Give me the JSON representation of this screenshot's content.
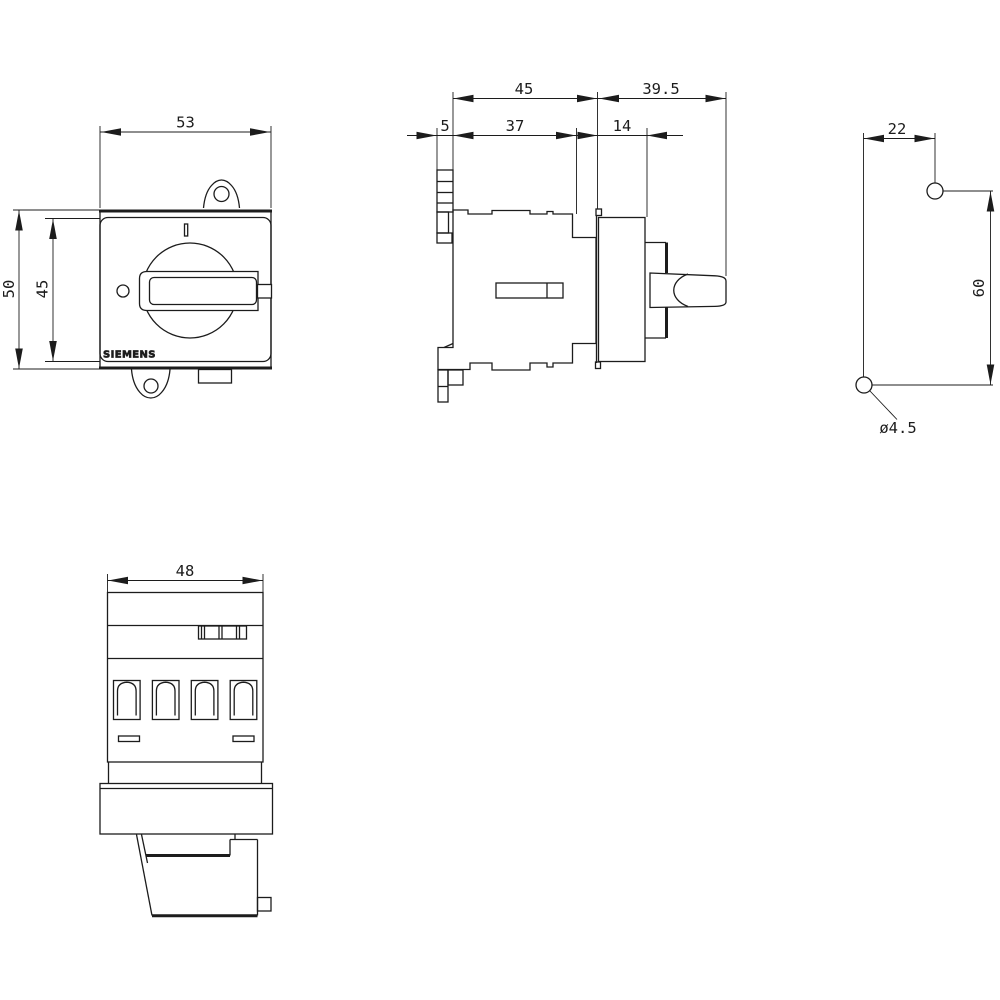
{
  "page": {
    "background": "#ffffff",
    "line_color": "#1c1c1c",
    "description": "Switch-disconnector dimension drawing, four orthographic views"
  },
  "front_view": {
    "width_mm": "53",
    "overall_height_mm": "50",
    "plate_height_mm": "45",
    "position_marker": "I",
    "brand": "SIEMENS"
  },
  "side_view": {
    "body_depth_mm": "45",
    "handle_depth_mm": "39.5",
    "clip_depth_mm": "5",
    "enclosure_depth_mm": "37",
    "plate_depth_mm": "14"
  },
  "drilling_plan": {
    "horizontal_pitch_mm": "22",
    "vertical_pitch_mm": "60",
    "hole_diameter": "ø4.5"
  },
  "bottom_view": {
    "width_mm": "48"
  }
}
